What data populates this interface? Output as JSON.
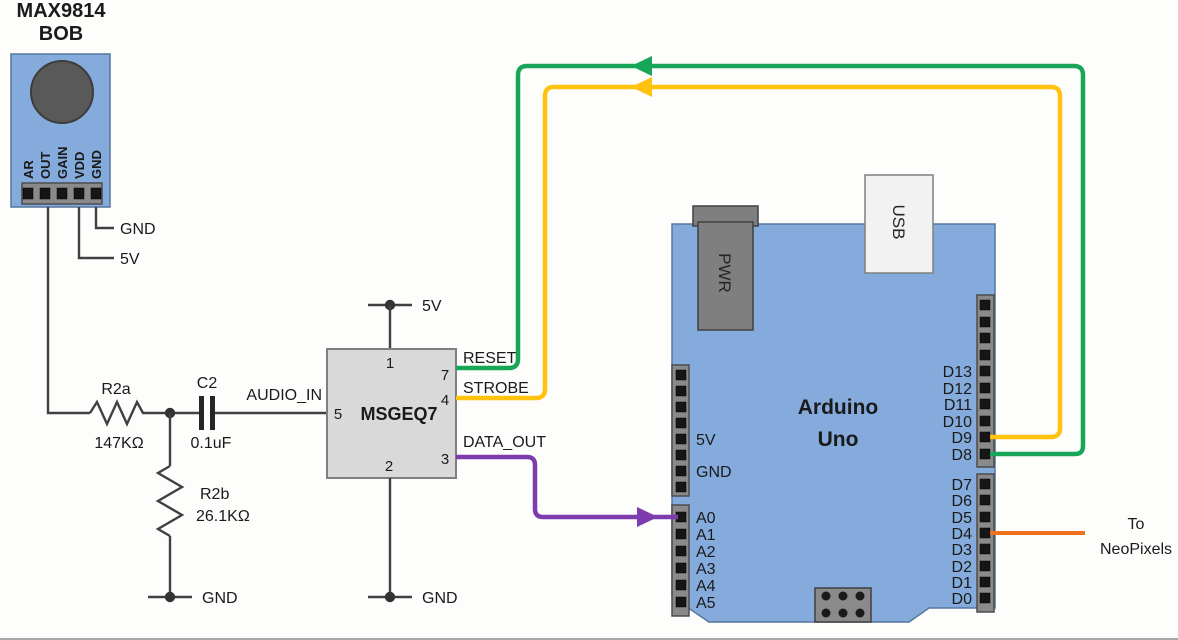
{
  "colors": {
    "wire_green": "#17a658",
    "wire_yellow": "#ffc20e",
    "wire_purple": "#7d3cad",
    "wire_orange": "#f0711d",
    "board_blue": "#84abdc",
    "chip_gray": "#d9d9d9",
    "header_gray": "#8a8a8a",
    "connector_dark_gray": "#7f7f7f",
    "usb_gray": "#f2f2f2"
  },
  "mic_module": {
    "title": [
      "MAX9814",
      "BOB"
    ],
    "pins": [
      "AR",
      "OUT",
      "GAIN",
      "VDD",
      "GND"
    ],
    "gnd_wire_label": "GND",
    "v5_wire_label": "5V"
  },
  "filter": {
    "r2a_name": "R2a",
    "r2a_value": "147KΩ",
    "c2_name": "C2",
    "c2_value": "0.1uF",
    "audio_in_label": "AUDIO_IN",
    "r2b_name": "R2b",
    "r2b_value": "26.1KΩ",
    "gnd_label": "GND"
  },
  "msgeq7": {
    "chip_name": "MSGEQ7",
    "v5_label": "5V",
    "gnd_label": "GND",
    "pin_numbers": {
      "top": "1",
      "left": "5",
      "bottom": "2",
      "reset": "7",
      "strobe": "4",
      "data_out": "3"
    },
    "signal_labels": {
      "reset": "RESET",
      "strobe": "STROBE",
      "data_out": "DATA_OUT"
    }
  },
  "arduino": {
    "title": [
      "Arduino",
      "Uno"
    ],
    "pwr_label": "PWR",
    "usb_label": "USB",
    "power_pin_labels": [
      "5V",
      "GND"
    ],
    "analog_pins": [
      "A0",
      "A1",
      "A2",
      "A3",
      "A4",
      "A5"
    ],
    "digital_pins_upper": [
      "D13",
      "D12",
      "D11",
      "D10",
      "D9",
      "D8"
    ],
    "digital_pins_lower": [
      "D7",
      "D6",
      "D5",
      "D4",
      "D3",
      "D2",
      "D1",
      "D0"
    ]
  },
  "output_label": {
    "line1": "To",
    "line2": "NeoPixels"
  }
}
